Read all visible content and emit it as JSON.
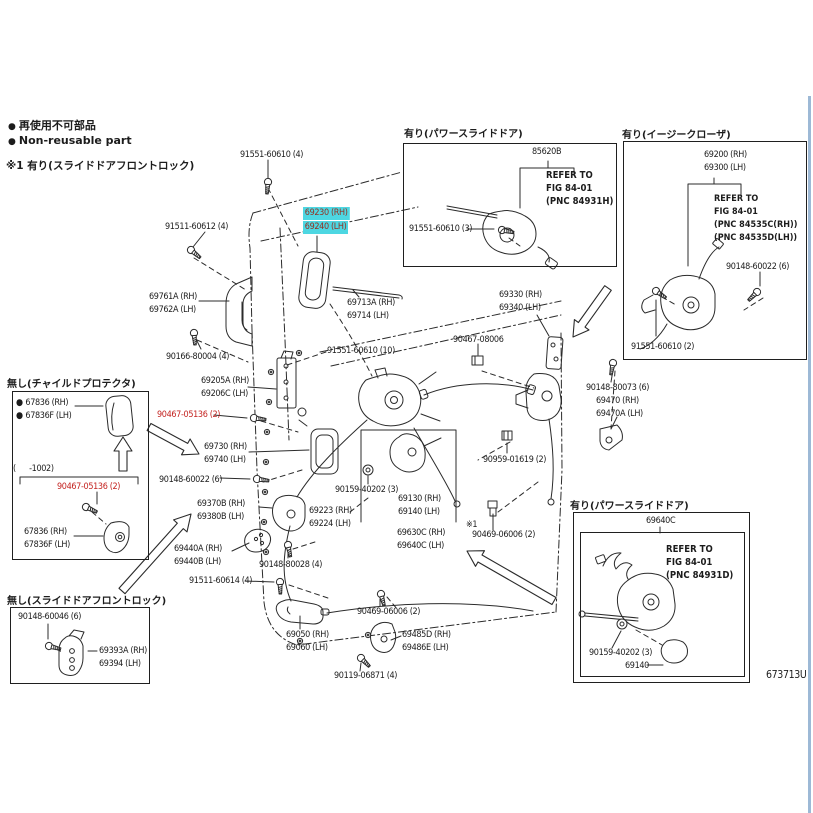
{
  "colors": {
    "ink": "#1c1c1c",
    "red": "#c42320",
    "hlbg": "#4dd7e2",
    "hltx": "#943122",
    "edge": "#9db9d6"
  },
  "icons": {
    "dot": "●"
  },
  "legend": {
    "non_reusable_jp": "再使用不可部品",
    "non_reusable_en": "Non-reusable part",
    "note1": "※1 有り(スライドドアフロントロック)"
  },
  "footer": {
    "figure_code": "673713U"
  },
  "highlight": {
    "rh": "69230 (RH)",
    "lh": "69240 (LH)"
  },
  "labels": {
    "l_91551_60610_4": "91551-60610 (4)",
    "l_91511_60612_4": "91511-60612 (4)",
    "l_69761A": {
      "rh": "69761A (RH)",
      "lh": "69762A (LH)"
    },
    "l_69713A": {
      "rh": "69713A (RH)",
      "lh": "69714 (LH)"
    },
    "l_90166_80004_4": "90166-80004 (4)",
    "l_91551_60610_10": "91551-60610 (10)",
    "l_69330": {
      "rh": "69330 (RH)",
      "lh": "69340 (LH)"
    },
    "l_90467_08006": "90467-08006",
    "l_69205A": {
      "rh": "69205A (RH)",
      "lh": "69206C (LH)"
    },
    "l_90467_05136_2": "90467-05136 (2)",
    "l_69730": {
      "rh": "69730 (RH)",
      "lh": "69740 (LH)"
    },
    "l_90148_60022_6": "90148-60022 (6)",
    "l_90148_80073_6": "90148-80073 (6)",
    "l_69470": {
      "rh": "69470 (RH)",
      "lh": "69470A (LH)"
    },
    "l_90959_01619_2": "90959-01619 (2)",
    "l_90159_40202_3": "90159-40202 (3)",
    "l_69130": {
      "rh": "69130 (RH)",
      "lh": "69140 (LH)"
    },
    "l_69370B": {
      "rh": "69370B (RH)",
      "lh": "69380B (LH)"
    },
    "l_69223": {
      "rh": "69223 (RH)",
      "lh": "69224 (LH)"
    },
    "l_ref1": "※1",
    "l_90469_06006_2a": "90469-06006 (2)",
    "l_69630C": {
      "rh": "69630C (RH)",
      "lh": "69640C (LH)"
    },
    "l_69440A": {
      "rh": "69440A (RH)",
      "lh": "69440B (LH)"
    },
    "l_90148_80028_4": "90148-80028 (4)",
    "l_91511_60614_4": "91511-60614 (4)",
    "l_90469_06006_2b": "90469-06006 (2)",
    "l_69050": {
      "rh": "69050 (RH)",
      "lh": "69060 (LH)"
    },
    "l_69485D": {
      "rh": "69485D (RH)",
      "lh": "69486E (LH)"
    },
    "l_90119_06871_4": "90119-06871 (4)"
  },
  "boxes": {
    "power_slide_top": {
      "title": "有り(パワースライドドア)",
      "part": "85620B",
      "refer": [
        "REFER TO",
        "FIG 84-01",
        "(PNC 84931H)"
      ],
      "bolt": "91551-60610 (3)"
    },
    "easy_closer": {
      "title": "有り(イージークローザ)",
      "part_rh": "69200 (RH)",
      "part_lh": "69300 (LH)",
      "refer": [
        "REFER TO",
        "FIG 84-01",
        "(PNC 84535C(RH))",
        "(PNC 84535D(LH))"
      ],
      "screw": "90148-60022 (6)",
      "bolt": "91551-60610 (2)"
    },
    "no_child_protector": {
      "title": "無し(チャイルドプロテクタ)",
      "part_a_rh": "67836 (RH)",
      "part_a_lh": "67836F (LH)",
      "range": "(      -1002)",
      "screw": "90467-05136 (2)",
      "part_b_rh": "67836 (RH)",
      "part_b_lh": "67836F (LH)"
    },
    "no_slide_front_lock": {
      "title": "無し(スライドドアフロントロック)",
      "screw": "90148-60046 (6)",
      "part_rh": "69393A (RH)",
      "part_lh": "69394 (LH)"
    },
    "power_slide_bottom": {
      "title": "有り(パワースライドドア)",
      "part": "69640C",
      "refer": [
        "REFER TO",
        "FIG 84-01",
        "(PNC 84931D)"
      ],
      "screw": "90159-40202 (3)",
      "part2": "69140"
    }
  }
}
